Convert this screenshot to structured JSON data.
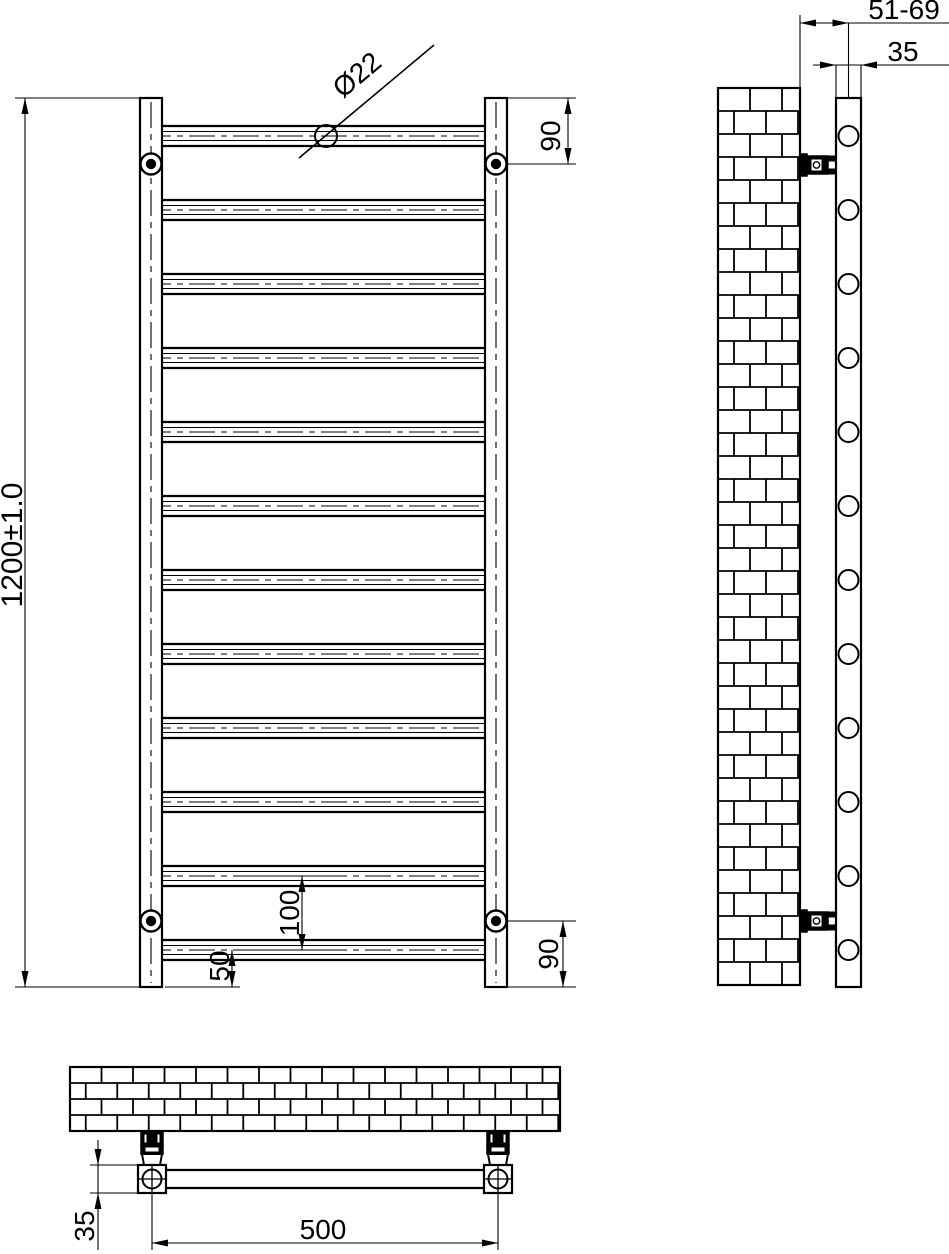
{
  "colors": {
    "line": "#000000",
    "background": "#ffffff"
  },
  "views": {
    "front": {
      "tube_count": 12,
      "bracket_marker_count": 4,
      "labels": {
        "overall_height": "1200±1.0",
        "tube_diameter": "Ø22",
        "top_bracket_offset": "90",
        "bottom_bracket_offset": "90",
        "tube_spacing": "100",
        "last_tube_to_end": "50"
      }
    },
    "side": {
      "tube_end_count": 12,
      "bracket_count": 2,
      "labels": {
        "wall_to_rail": "51-69",
        "rail_depth": "35"
      }
    },
    "plan": {
      "bracket_count": 2,
      "labels": {
        "rail_centres": "500",
        "rail_depth": "35"
      }
    }
  }
}
